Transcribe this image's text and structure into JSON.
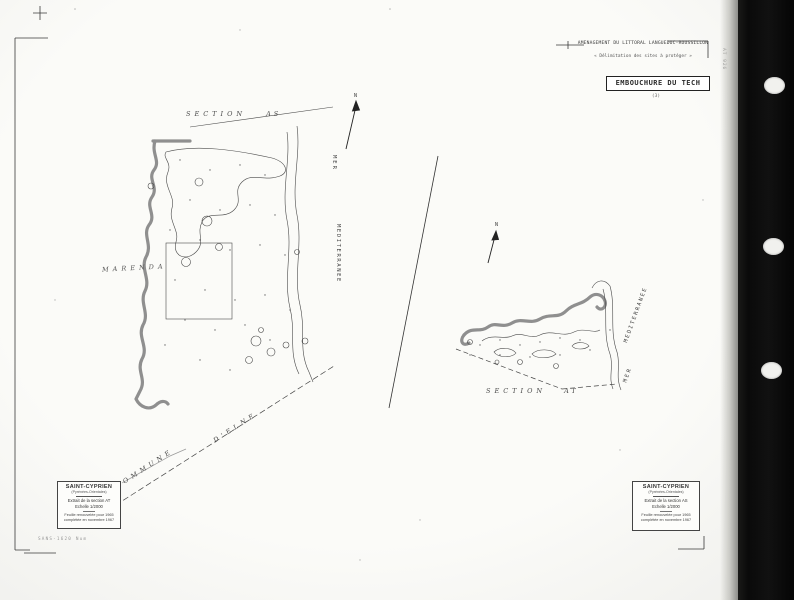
{
  "header": {
    "line1": "AMENAGEMENT DU LITTORAL LANGUEDOC-ROUSSILLON",
    "line2": "« Délimitation des sites à protéger »",
    "title": "EMBOUCHURE DU TECH",
    "number": "(3)",
    "edge_code": "AT 926"
  },
  "maps": {
    "left": {
      "section_label": "SECTION",
      "section_value": "AS",
      "sea_word1": "MER",
      "sea_word2": "MEDITERRANEE",
      "place_label": "MARENDA",
      "commune_word1": "COMMUNE",
      "commune_word2": "D'ELNE",
      "north": "N"
    },
    "right": {
      "section_label": "SECTION",
      "section_value": "AT",
      "sea_word1": "MER",
      "sea_word2": "MEDITERRANEE",
      "north": "N"
    }
  },
  "cartouche_left": {
    "commune": "SAINT-CYPRIEN",
    "departement": "(Pyrénées-Orientales)",
    "extract": "Extrait de la section AT",
    "scale": "Echelle 1/2000",
    "note1": "Feuille renouvelée pour 1965",
    "note2": "complétée en novembre 1967"
  },
  "cartouche_right": {
    "commune": "SAINT-CYPRIEN",
    "departement": "(Pyrénées-Orientales)",
    "extract": "Extrait de la section AS",
    "scale": "Echelle 1/2000",
    "note1": "Feuille renouvelée pour 1965",
    "note2": "complétée en novembre 1967"
  },
  "footer": {
    "archive_ref": "SANS-1620  Num"
  },
  "colors": {
    "ink": "#2b2b2b",
    "boundary_gray": "#8f8f8f",
    "paper": "#fbfbf8",
    "binder_strip": "#0a0a0a"
  }
}
